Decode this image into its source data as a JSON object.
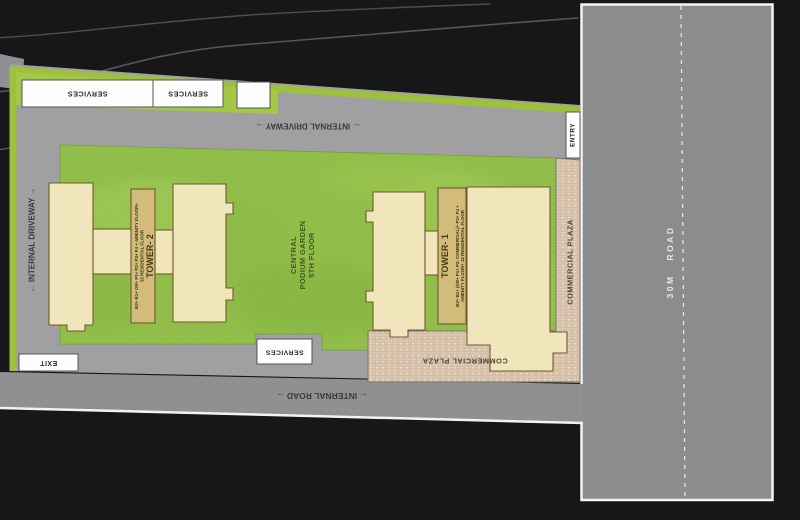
{
  "colors": {
    "background": "#17171a",
    "road_gray": "#8b8c8e",
    "internal_road_gray": "#909092",
    "plot_gray": "#a0a0a2",
    "lime_band": "#9dc13c",
    "services_strip_green": "#a3c746",
    "garden_green": "#8cbe3e",
    "tower_cream": "#f1e6bb",
    "tower_core_tan": "#d2bb7b",
    "plaza_tan": "#dcc9b5",
    "label_box_white": "#fdfdfd"
  },
  "roads": {
    "main_road_label": "30M ROAD",
    "internal_road_label": "← INTERNAL ROAD →",
    "internal_driveway_top_label": "← INTERNAL DRIVEWAY →",
    "internal_driveway_left_label": "← INTERNAL DRIVEWAY →",
    "entry_label": "ENTRY",
    "exit_label": "EXIT"
  },
  "services": {
    "box1": "SERVICES",
    "box2": "SERVICES",
    "bottom": "SERVICES"
  },
  "garden": {
    "line1": "CENTRAL",
    "line2": "PODIUM GARDEN",
    "line3": "5TH FLOOR"
  },
  "towers": {
    "tower2": {
      "name": "TOWER- 2",
      "desc1": "B2+ B1+ GR+ P1+ P2+ P3+ P4 + AMENITY FLOOR+",
      "desc2": "32 RESIDENTIAL FLOOR"
    },
    "tower1": {
      "name": "TOWER- 1",
      "desc1": "B2+ B1+ (GR+ P1+ P2: COMMERCIAL)+ P3+ P4 +",
      "desc2": "AMENITY FLOOR+ 32 RESIDENTIAL FLOOR"
    }
  },
  "plaza": {
    "side_label": "COMMERCIAL PLAZA",
    "bottom_label": "COMMERCIAL PLAZA"
  }
}
